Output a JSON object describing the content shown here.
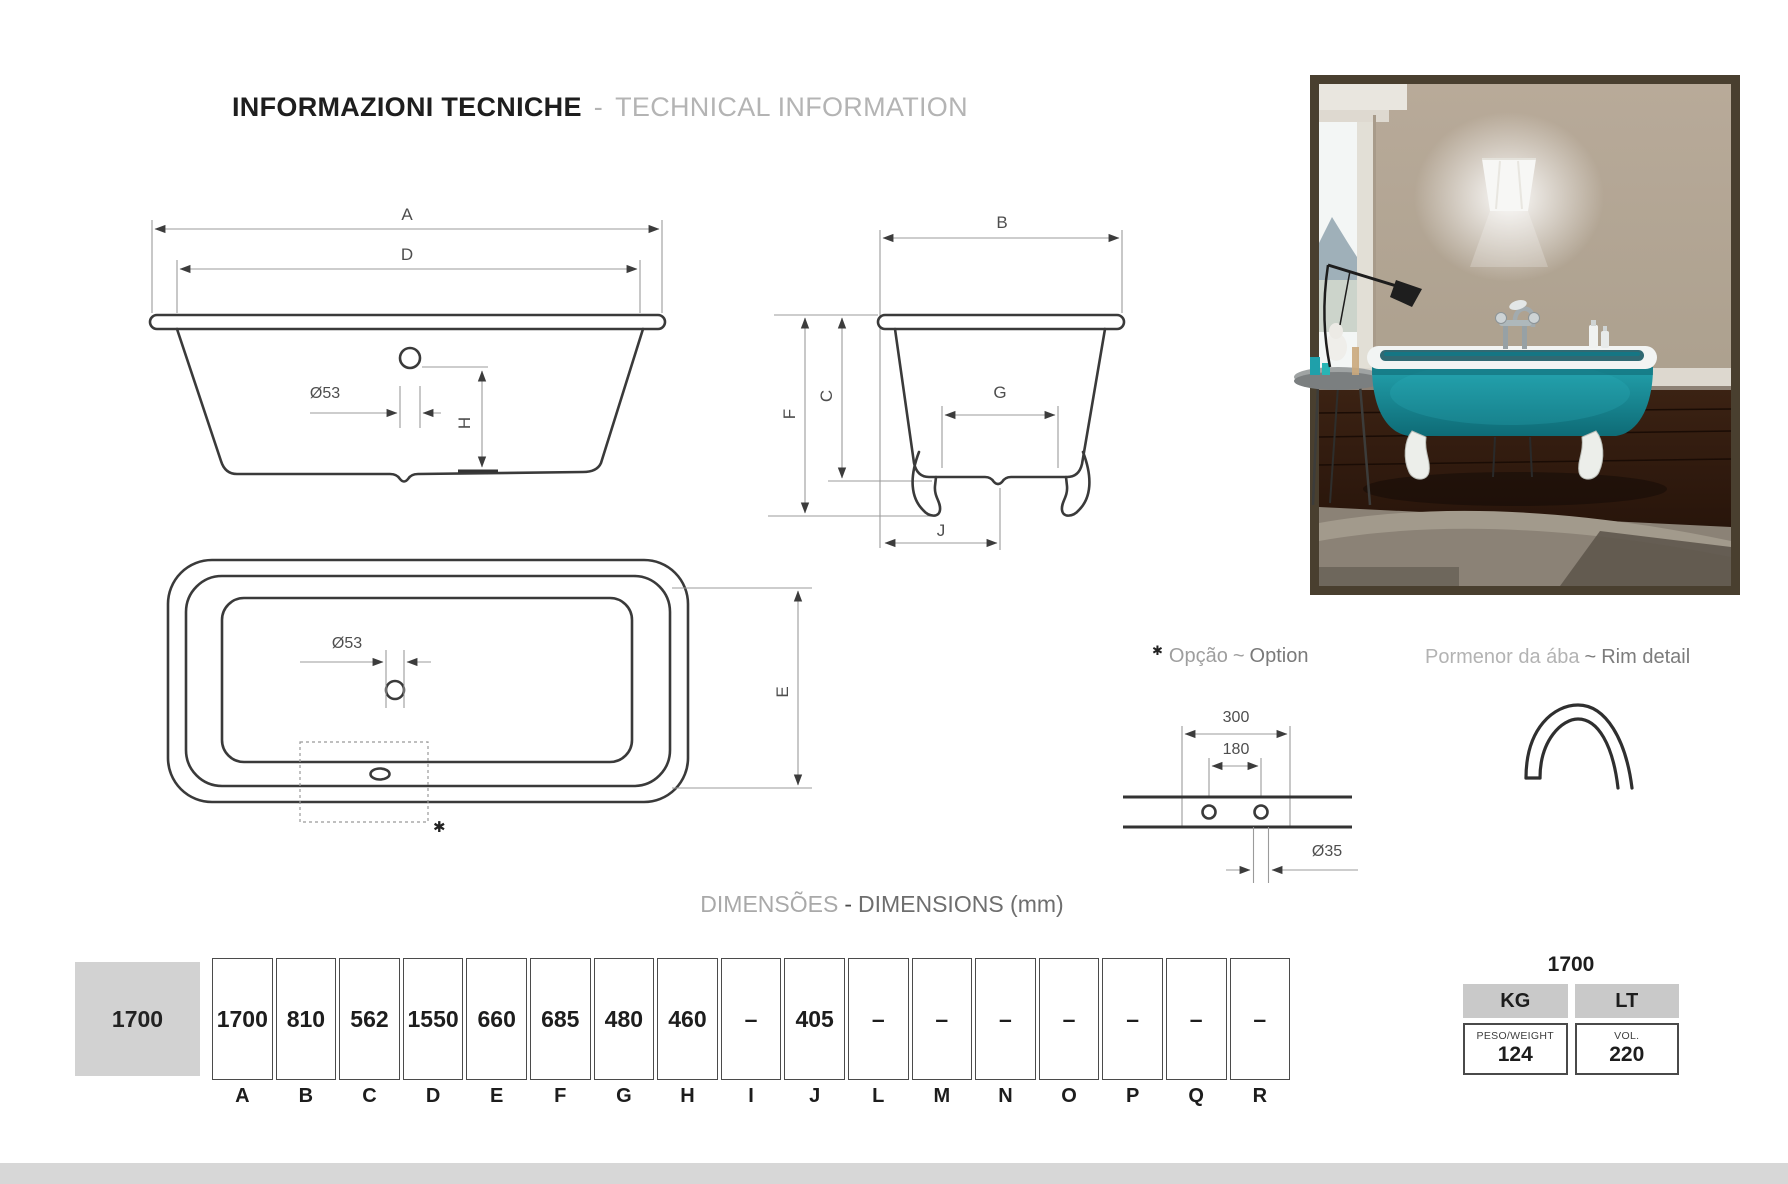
{
  "header": {
    "title_it": "INFORMAZIONI TECNICHE",
    "title_sep": "-",
    "title_en": "TECHNICAL INFORMATION"
  },
  "drawings": {
    "side_view": {
      "dim_a": "A",
      "dim_d": "D",
      "drain_diameter": "Ø53",
      "dim_h": "H"
    },
    "end_view": {
      "dim_b": "B",
      "dim_f": "F",
      "dim_c": "C",
      "dim_g": "G",
      "dim_j": "J"
    },
    "top_view": {
      "drain_diameter": "Ø53",
      "dim_e": "E",
      "option_marker": "✱"
    }
  },
  "option_detail": {
    "marker": "✱",
    "label_pt": "Opção",
    "separator": "~",
    "label_en": "Option",
    "dim_outer": "300",
    "dim_inner": "180",
    "hole_diameter": "Ø35"
  },
  "rim_detail": {
    "label_pt": "Pormenor da ába",
    "separator": "~",
    "label_en": "Rim detail"
  },
  "dimensions_table": {
    "title_pt": "DIMENSÕES",
    "title_sep": "-",
    "title_en": "DIMENSIONS (mm)",
    "row_label": "1700",
    "columns": [
      "A",
      "B",
      "C",
      "D",
      "E",
      "F",
      "G",
      "H",
      "I",
      "J",
      "L",
      "M",
      "N",
      "O",
      "P",
      "Q",
      "R"
    ],
    "values": [
      "1700",
      "810",
      "562",
      "1550",
      "660",
      "685",
      "480",
      "460",
      "–",
      "405",
      "–",
      "–",
      "–",
      "–",
      "–",
      "–",
      "–"
    ]
  },
  "weight_table": {
    "title": "1700",
    "col_kg": "KG",
    "col_lt": "LT",
    "weight_label": "PESO/WEIGHT",
    "weight_value": "124",
    "volume_label": "VOL.",
    "volume_value": "220"
  },
  "colors": {
    "tub_teal": "#1b919d",
    "photo_wall": "#b2a492",
    "photo_frame": "#493f2f",
    "photo_floor": "#311c0f",
    "rug_gray": "#8b8276",
    "title_gray": "#b4b4b4",
    "drawing_line": "#3a3a3a",
    "table_gray_box": "#d2d2d2"
  }
}
